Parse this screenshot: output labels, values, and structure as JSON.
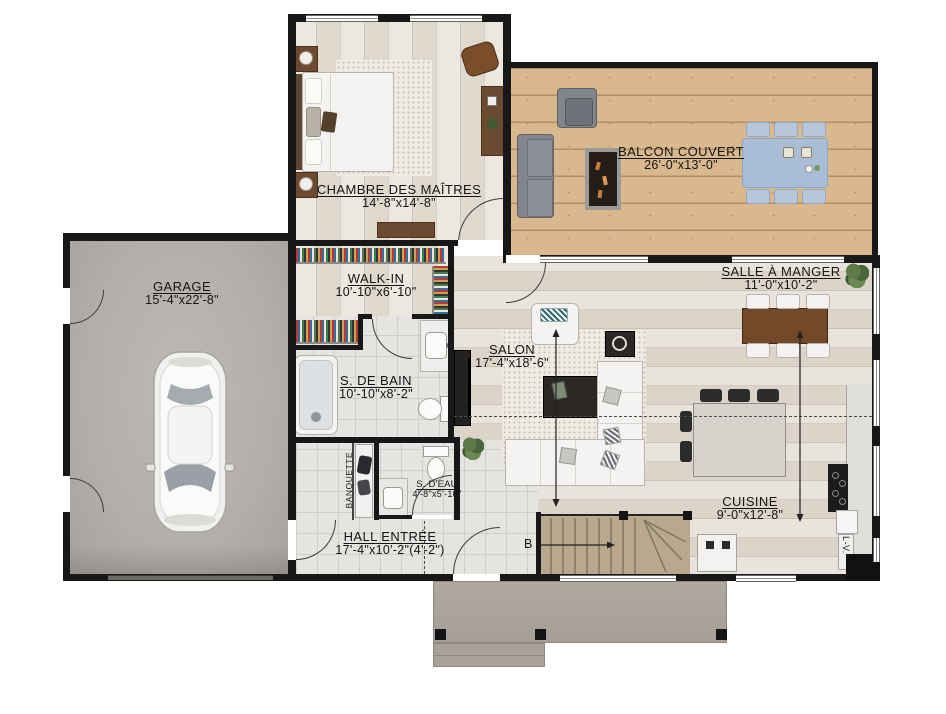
{
  "rooms": {
    "garage": {
      "name": "GARAGE",
      "dims": "15'-4\"x22'-8\""
    },
    "chambre_des_maitres": {
      "name": "CHAMBRE DES MAÎTRES",
      "dims": "14'-8\"x14'-8\""
    },
    "balcon_couvert": {
      "name": "BALCON COUVERT",
      "dims": "26'-0\"x13'-0\""
    },
    "walk_in": {
      "name": "WALK-IN",
      "dims": "10'-10\"x6'-10\""
    },
    "salle_de_bain": {
      "name": "S. DE BAIN",
      "dims": "10'-10\"x8'-2\""
    },
    "salle_deau": {
      "name": "S. D'EAU",
      "dims": "4'-8\"x5'-10\""
    },
    "salon": {
      "name": "SALON",
      "dims": "17'-4\"x18'-6\""
    },
    "salle_a_manger": {
      "name": "SALLE À MANGER",
      "dims": "11'-0\"x10'-2\""
    },
    "cuisine": {
      "name": "CUISINE",
      "dims": "9'-0\"x12'-8\""
    },
    "hall_entree": {
      "name": "HALL ENTRÉE",
      "dims": "17'-4\"x10'-2\"(4'-2\")"
    }
  },
  "annotations": {
    "banquette": "BANQUETTE",
    "stairs_label": "B",
    "dishwasher": "L-V."
  },
  "colors": {
    "wall": "#191818",
    "interior_wood": "#e4ddd2",
    "deck_wood": "#d9b88d",
    "garage_floor": "#b2aea9",
    "tile": "#e5e4e1",
    "porch": "#aba59e",
    "stair_wood": "#b7a88e"
  }
}
